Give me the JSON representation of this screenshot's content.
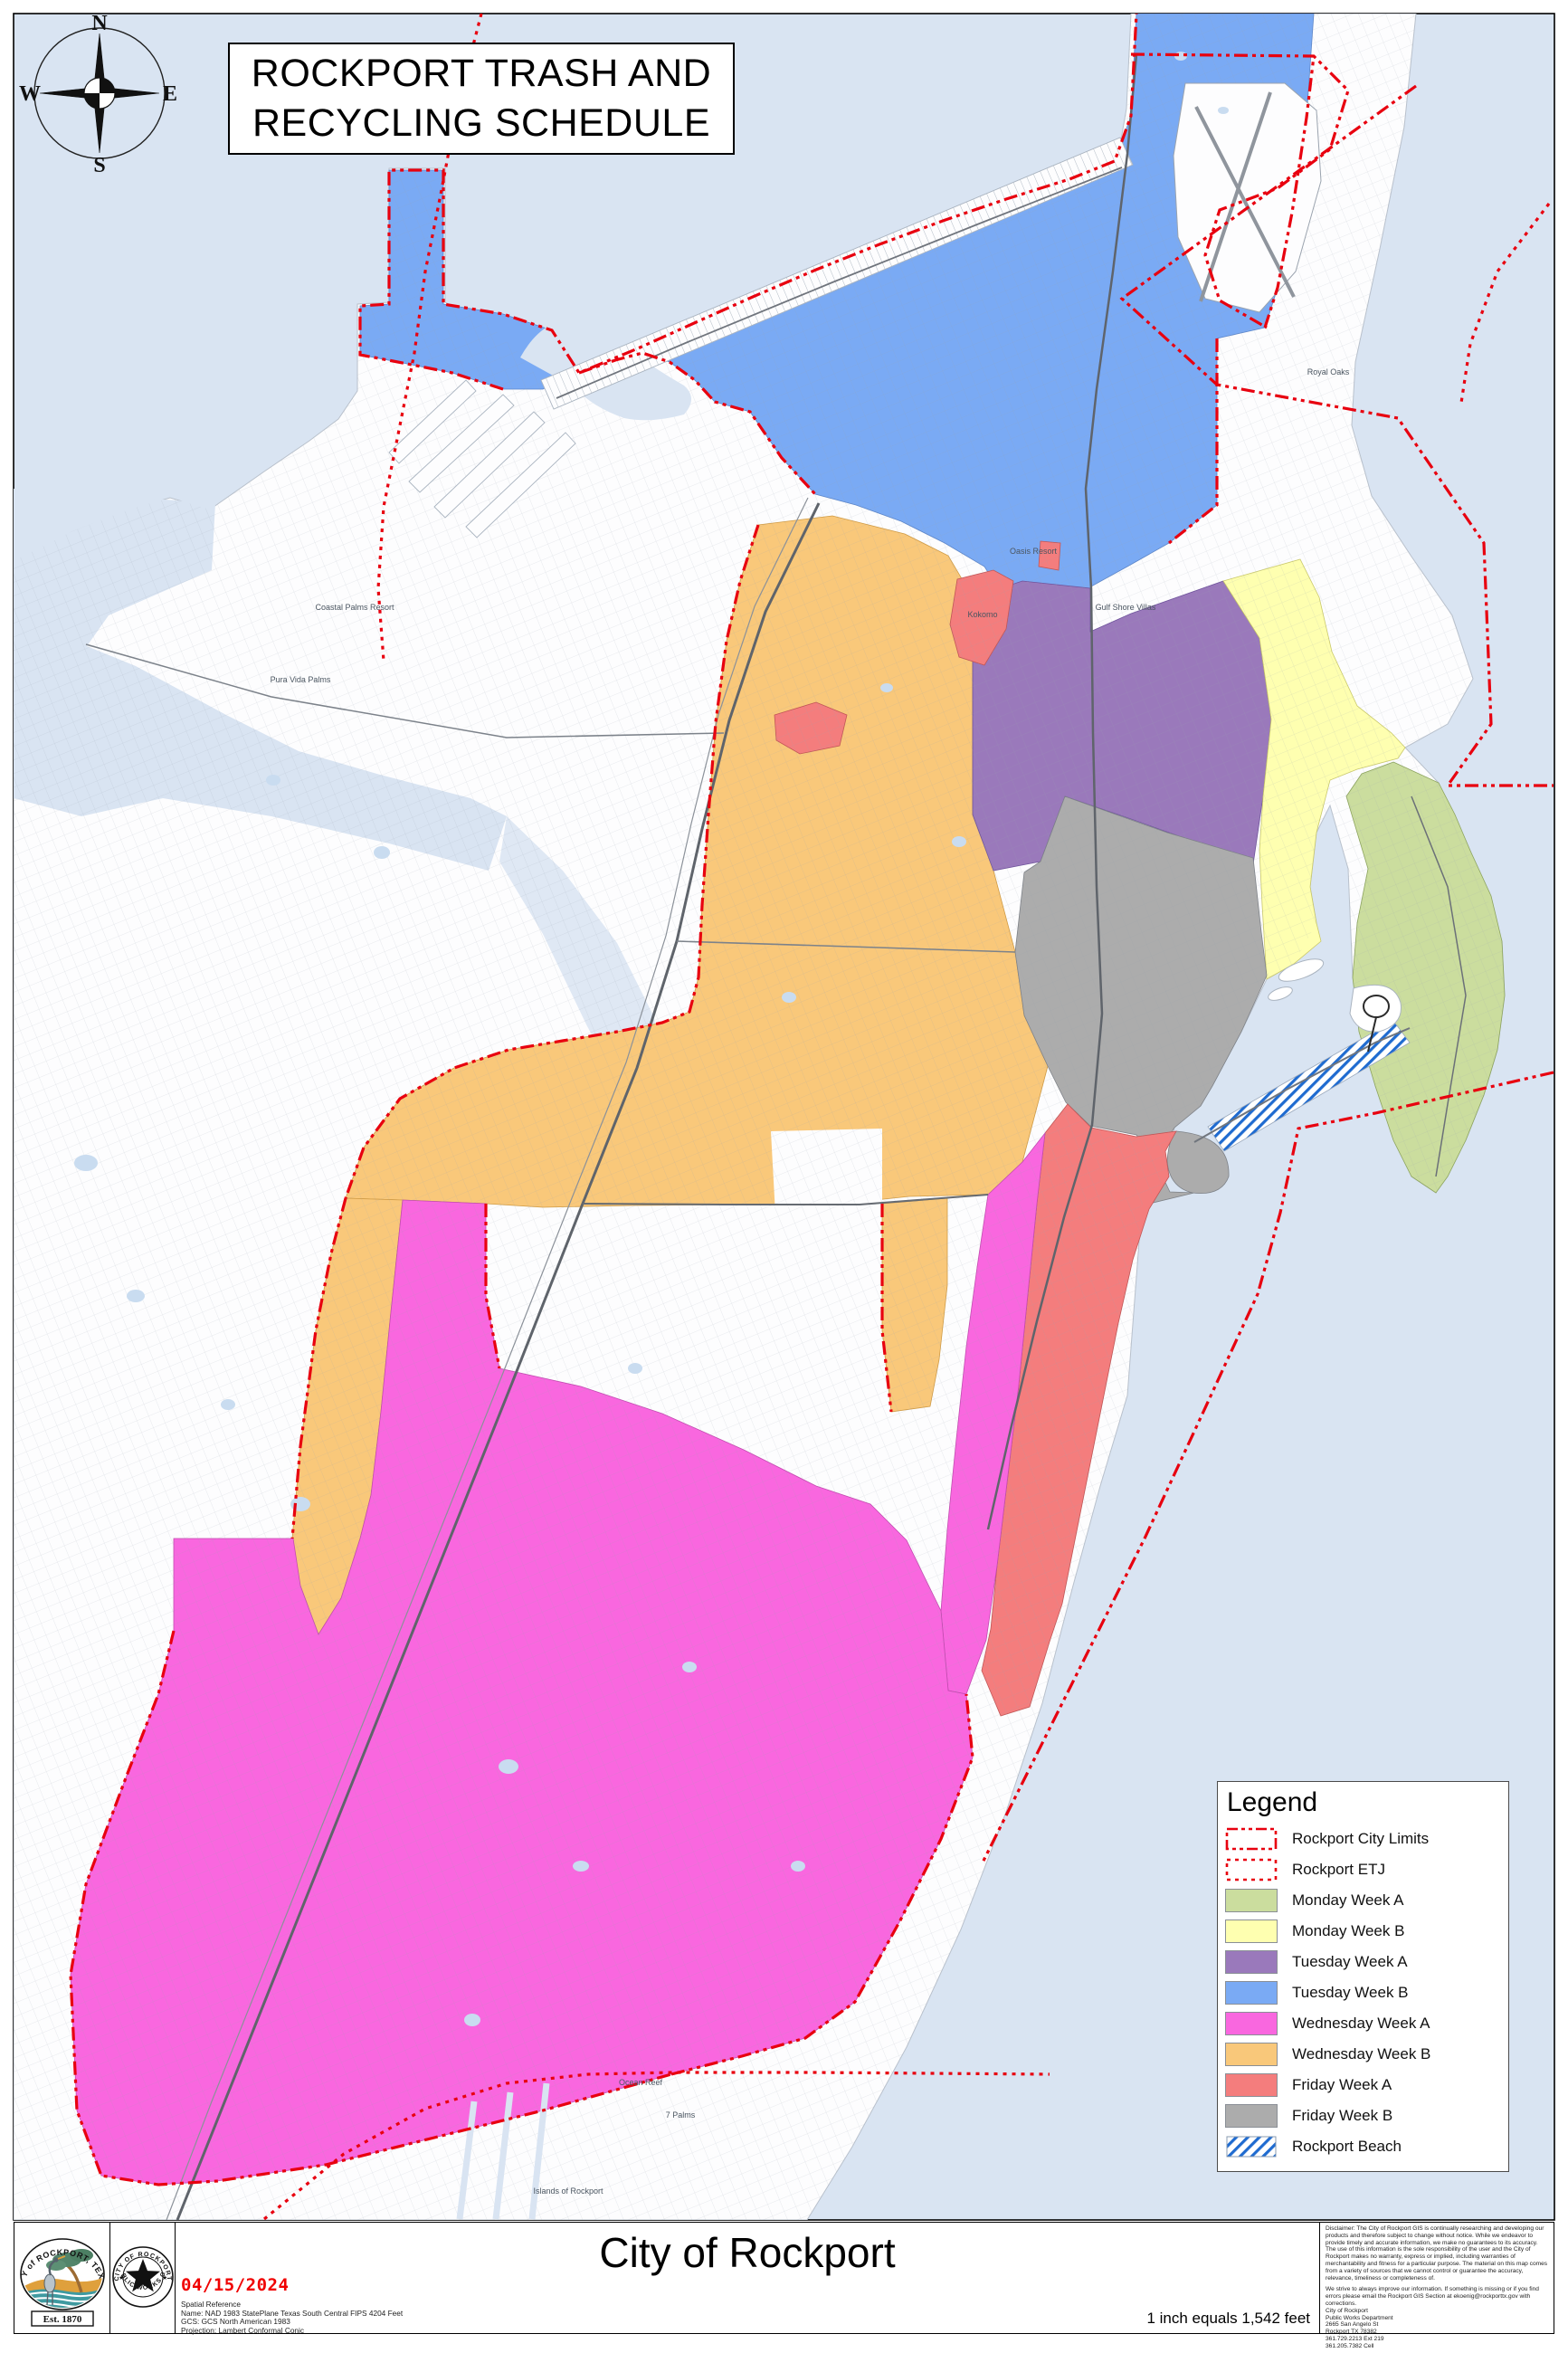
{
  "title": {
    "line1": "ROCKPORT TRASH AND",
    "line2": "RECYCLING SCHEDULE"
  },
  "compass": {
    "n": "N",
    "s": "S",
    "e": "E",
    "w": "W"
  },
  "colors": {
    "water": "#d9e4f2",
    "land": "#fdfdfe",
    "pond": "#c9dcf0",
    "limits_red": "#e8000f",
    "monday_a": "#cbdd9e",
    "monday_b": "#feffb0",
    "tuesday_a": "#9a79bb",
    "tuesday_b": "#7aaaf4",
    "wednesday_a": "#f967df",
    "wednesday_b": "#f9c87a",
    "friday_a": "#f47d7d",
    "friday_b": "#acacac",
    "beach_stripe": "#1f6bd0"
  },
  "legend": {
    "title": "Legend",
    "items": [
      {
        "label": "Rockport City Limits"
      },
      {
        "label": "Rockport ETJ"
      },
      {
        "label": "Monday Week A"
      },
      {
        "label": "Monday Week B"
      },
      {
        "label": "Tuesday Week A"
      },
      {
        "label": "Tuesday Week B"
      },
      {
        "label": "Wednesday Week A"
      },
      {
        "label": "Wednesday Week B"
      },
      {
        "label": "Friday Week A"
      },
      {
        "label": "Friday Week B"
      },
      {
        "label": "Rockport Beach"
      }
    ]
  },
  "map_labels": {
    "oasis": "Oasis Resort",
    "gulf_shore": "Gulf Shore Villas",
    "kokomo": "Kokomo",
    "royal_oaks": "Royal Oaks",
    "coastal_palms": "Coastal Palms Resort",
    "pura_vida": "Pura Vida Palms",
    "ocean_reef": "Ocean Reef",
    "seven_palms": "7 Palms",
    "islands": "Islands of Rockport"
  },
  "footer": {
    "city_seal": {
      "arc_text": "CITY of ROCKPORT, TEXAS",
      "banner": "Est. 1870"
    },
    "gis_seal": {
      "arc_top": "CITY OF ROCKPORT",
      "arc_bottom": "PUBLIC WORKS GIS"
    },
    "date": "04/15/2024",
    "spatial_reference": "Spatial Reference\nName: NAD 1983 StatePlane Texas South Central FIPS 4204 Feet\nGCS: GCS North American 1983\nProjection: Lambert Conformal Conic",
    "map_title": "City of Rockport",
    "scale_text": "1 inch equals 1,542 feet",
    "disclaimer_p1": "Disclaimer: The City of Rockport GIS is continually researching and developing our products and therefore subject to change without notice. While we endeavor to provide timely and accurate information, we make no guarantees to its accuracy. The use of this information is the sole responsibility of the user and the City of Rockport makes no warranty, express or implied, including warranties of merchantability and fitness for a particular purpose. The material on this map comes from a variety of sources that we cannot control or guarantee the accuracy, relevance, timeliness or completeness of.",
    "disclaimer_p2": "We strive to always improve our information. If something is missing or if you find errors please email the Rockport GIS Section at ekoenig@rockporttx.gov with corrections.",
    "address": "City of Rockport\nPublic Works Department\n2665 San Angelo St\nRockport TX 78382\n361.729.2213 Ext 219\n361.205.7382 Cell"
  }
}
